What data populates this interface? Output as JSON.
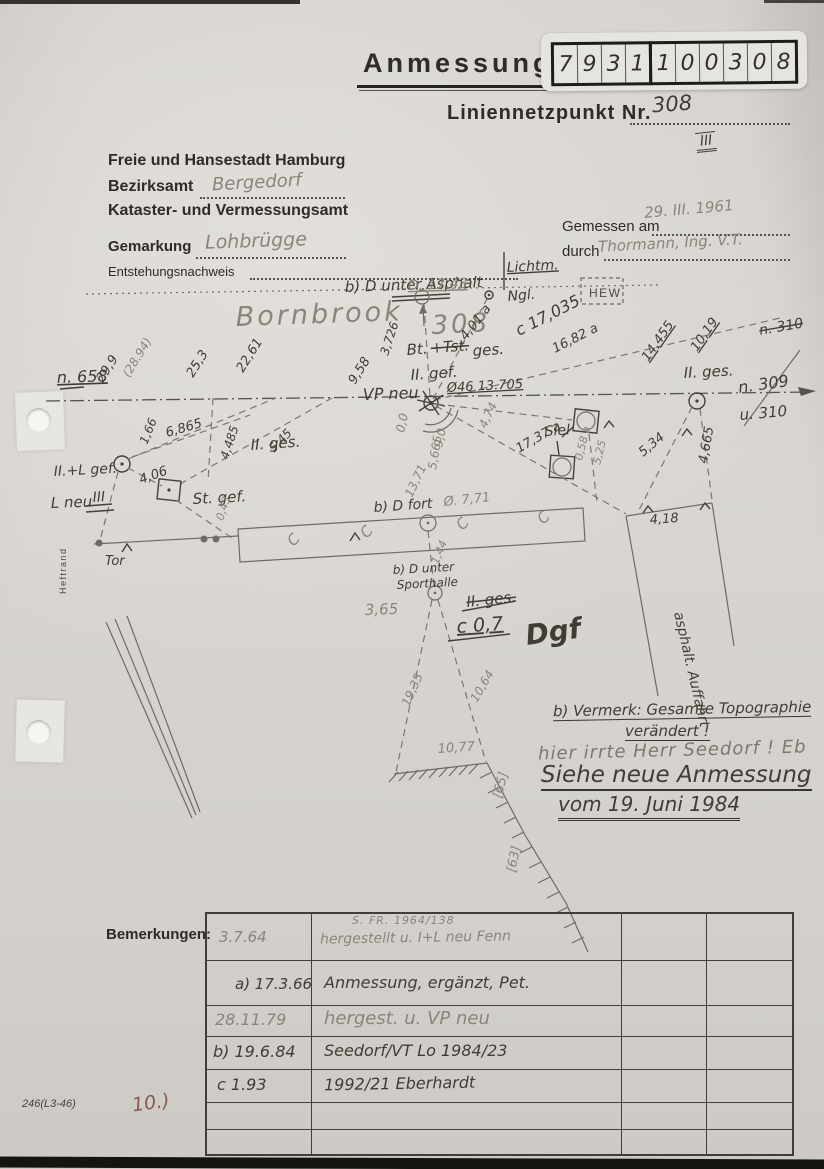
{
  "page": {
    "title": "Anmessung",
    "form_number": "246(L3-46)",
    "page_note": "10.)"
  },
  "number_box": {
    "digits": [
      "7",
      "9",
      "3",
      "1",
      "1",
      "0",
      "0",
      "3",
      "0",
      "8"
    ]
  },
  "point": {
    "label": "Liniennetzpunkt Nr.",
    "value": "308",
    "revision_mark": "III"
  },
  "header": {
    "authority_line1": "Freie und Hansestadt Hamburg",
    "bezirksamt_label": "Bezirksamt",
    "bezirksamt_value": "Bergedorf",
    "authority_line2": "Kataster- und Vermessungsamt",
    "gemarkung_label": "Gemarkung",
    "gemarkung_value": "Lohbrügge",
    "entstehung_label": "Entstehungsnachweis",
    "gemessen_label": "Gemessen am",
    "gemessen_value": "29. III. 1961",
    "durch_label": "durch",
    "durch_value": "Thormann, Ing. V.T."
  },
  "notes": {
    "vermerk_line1": "b) Vermerk: Gesamte Topographie",
    "vermerk_line2": "verändert !",
    "pencil_note": "hier irrte Herr Seedorf ! Eb",
    "see_new_line1": "Siehe neue Anmessung",
    "see_new_line2": "vom 19. Juni 1984"
  },
  "remarks_table": {
    "label": "Bemerkungen:",
    "rows": [
      {
        "date": "3.7.64",
        "note_top": "S. FR. 1964/138",
        "note": "hergestellt u. I+L neu Fenn"
      },
      {
        "date": "a) 17.3.66",
        "note_top": "",
        "note": "Anmessung, ergänzt, Pet."
      },
      {
        "date": "28.11.79",
        "note_top": "",
        "note": "hergest. u. VP neu"
      },
      {
        "date": "b) 19.6.84",
        "note_top": "",
        "note": "Seedorf/VT  Lo 1984/23"
      },
      {
        "date": "c  1.93",
        "note_top": "",
        "note": "1992/21  Eberhardt"
      },
      {
        "date": "",
        "note_top": "",
        "note": ""
      },
      {
        "date": "",
        "note_top": "",
        "note": ""
      }
    ]
  },
  "sketch": {
    "labels": [
      {
        "t": "Lichtm.",
        "x": 507,
        "y": 272,
        "r": -3,
        "c": "ink u",
        "s": 14
      },
      {
        "t": "b) D unter Asphalt",
        "x": 345,
        "y": 292,
        "r": -2,
        "c": "ink",
        "s": 15
      },
      {
        "t": "D. 17.43",
        "x": 408,
        "y": 290,
        "r": -2,
        "c": "pencil u",
        "s": 14
      },
      {
        "t": "Bornbrook",
        "x": 236,
        "y": 326,
        "r": -2,
        "c": "pencil big",
        "s": 27
      },
      {
        "t": "308",
        "x": 432,
        "y": 334,
        "r": -3,
        "c": "pencil big",
        "s": 26
      },
      {
        "t": "Ngl.",
        "x": 508,
        "y": 301,
        "r": -5,
        "c": "ink",
        "s": 14
      },
      {
        "t": "4,01 a",
        "x": 466,
        "y": 341,
        "r": -52,
        "c": "ink",
        "s": 13
      },
      {
        "t": "c 17,035",
        "x": 519,
        "y": 336,
        "r": -27,
        "c": "ink",
        "s": 16
      },
      {
        "t": "16,82 a",
        "x": 555,
        "y": 353,
        "r": -27,
        "c": "ink",
        "s": 13
      },
      {
        "t": "HEW",
        "x": 589,
        "y": 297,
        "r": 0,
        "c": "print",
        "s": 12
      },
      {
        "t": "n. 310",
        "x": 760,
        "y": 335,
        "r": -10,
        "c": "ink strike",
        "s": 14
      },
      {
        "t": "14,455",
        "x": 648,
        "y": 362,
        "r": -55,
        "c": "ink u",
        "s": 13
      },
      {
        "t": "10,19",
        "x": 697,
        "y": 352,
        "r": -55,
        "c": "ink u",
        "s": 13
      },
      {
        "t": "II. ges.",
        "x": 684,
        "y": 378,
        "r": -3,
        "c": "ink",
        "s": 15
      },
      {
        "t": "n. 309",
        "x": 739,
        "y": 393,
        "r": -8,
        "c": "ink",
        "s": 16
      },
      {
        "t": "u. 310",
        "x": 740,
        "y": 420,
        "r": -5,
        "c": "ink",
        "s": 15
      },
      {
        "t": "n. 658",
        "x": 57,
        "y": 383,
        "r": -2,
        "c": "ink u",
        "s": 16
      },
      {
        "t": "29,9",
        "x": 103,
        "y": 383,
        "r": -58,
        "c": "ink",
        "s": 13
      },
      {
        "t": "(28.94)",
        "x": 129,
        "y": 378,
        "r": -58,
        "c": "pencil",
        "s": 12
      },
      {
        "t": "25,3",
        "x": 193,
        "y": 378,
        "r": -58,
        "c": "ink",
        "s": 13
      },
      {
        "t": "22,61",
        "x": 243,
        "y": 373,
        "r": -58,
        "c": "ink",
        "s": 13
      },
      {
        "t": "9,58",
        "x": 355,
        "y": 385,
        "r": -58,
        "c": "ink",
        "s": 13
      },
      {
        "t": "3,726",
        "x": 388,
        "y": 356,
        "r": -72,
        "c": "ink",
        "s": 12
      },
      {
        "t": "Bt.",
        "x": 407,
        "y": 355,
        "r": -4,
        "c": "ink",
        "s": 15
      },
      {
        "t": "+Tst.",
        "x": 431,
        "y": 353,
        "r": -4,
        "c": "ink strike",
        "s": 15
      },
      {
        "t": "ges.",
        "x": 473,
        "y": 356,
        "r": -4,
        "c": "ink",
        "s": 15
      },
      {
        "t": "II. gef.",
        "x": 411,
        "y": 380,
        "r": -4,
        "c": "ink",
        "s": 15
      },
      {
        "t": "VP neu",
        "x": 363,
        "y": 400,
        "r": -2,
        "c": "ink",
        "s": 16
      },
      {
        "t": "Ø46 13.705",
        "x": 447,
        "y": 392,
        "r": -3,
        "c": "ink u",
        "s": 13
      },
      {
        "t": "0,0",
        "x": 404,
        "y": 433,
        "r": -78,
        "c": "pencil",
        "s": 12
      },
      {
        "t": "9,0",
        "x": 442,
        "y": 448,
        "r": -78,
        "c": "pencil",
        "s": 12
      },
      {
        "t": "5,665",
        "x": 436,
        "y": 470,
        "r": -80,
        "c": "pencil",
        "s": 12
      },
      {
        "t": "4,74",
        "x": 486,
        "y": 429,
        "r": -65,
        "c": "pencil",
        "s": 12
      },
      {
        "t": "13,71",
        "x": 412,
        "y": 498,
        "r": -65,
        "c": "pencil",
        "s": 12
      },
      {
        "t": "Ø. 7,71",
        "x": 444,
        "y": 506,
        "r": -6,
        "c": "pencil",
        "s": 13
      },
      {
        "t": "b) D fort",
        "x": 374,
        "y": 512,
        "r": -4,
        "c": "ink",
        "s": 14
      },
      {
        "t": "17,37 a",
        "x": 519,
        "y": 453,
        "r": -30,
        "c": "ink",
        "s": 13
      },
      {
        "t": "1,66",
        "x": 147,
        "y": 445,
        "r": -68,
        "c": "ink",
        "s": 12
      },
      {
        "t": "6,865",
        "x": 167,
        "y": 437,
        "r": -16,
        "c": "ink",
        "s": 13
      },
      {
        "t": "4,485",
        "x": 228,
        "y": 460,
        "r": -72,
        "c": "ink",
        "s": 12
      },
      {
        "t": "5,45",
        "x": 274,
        "y": 453,
        "r": -46,
        "c": "ink",
        "s": 12
      },
      {
        "t": "II.+L gef.",
        "x": 54,
        "y": 476,
        "r": -3,
        "c": "ink",
        "s": 14
      },
      {
        "t": "4,06",
        "x": 141,
        "y": 484,
        "r": -20,
        "c": "ink",
        "s": 13
      },
      {
        "t": "L neu",
        "x": 51,
        "y": 508,
        "r": -2,
        "c": "ink",
        "s": 15
      },
      {
        "t": "III",
        "x": 93,
        "y": 502,
        "r": -4,
        "c": "ink",
        "s": 14
      },
      {
        "t": "St. gef.",
        "x": 193,
        "y": 504,
        "r": -3,
        "c": "ink",
        "s": 15
      },
      {
        "t": "II. ges.",
        "x": 251,
        "y": 450,
        "r": -4,
        "c": "ink",
        "s": 15
      },
      {
        "t": "0,43",
        "x": 223,
        "y": 521,
        "r": -72,
        "c": "pencil",
        "s": 11
      },
      {
        "t": "Tor",
        "x": 105,
        "y": 565,
        "r": 0,
        "c": "ink",
        "s": 13
      },
      {
        "t": "Heftrand",
        "x": 66,
        "y": 594,
        "r": -90,
        "c": "print-sm",
        "s": 9
      },
      {
        "t": "Siel",
        "x": 545,
        "y": 436,
        "r": -4,
        "c": "ink",
        "s": 14
      },
      {
        "t": "0,58 a",
        "x": 582,
        "y": 461,
        "r": -76,
        "c": "pencil",
        "s": 11
      },
      {
        "t": "5,25",
        "x": 600,
        "y": 465,
        "r": -76,
        "c": "pencil",
        "s": 11
      },
      {
        "t": "5,34",
        "x": 643,
        "y": 457,
        "r": -40,
        "c": "ink",
        "s": 13
      },
      {
        "t": "4,665",
        "x": 707,
        "y": 464,
        "r": -80,
        "c": "ink",
        "s": 13
      },
      {
        "t": "4,18",
        "x": 650,
        "y": 524,
        "r": -4,
        "c": "ink",
        "s": 13
      },
      {
        "t": "asphalt. Auffahrt",
        "x": 674,
        "y": 613,
        "r": 77,
        "c": "ink",
        "s": 14
      },
      {
        "t": "b) D unter",
        "x": 393,
        "y": 574,
        "r": -3,
        "c": "ink",
        "s": 12
      },
      {
        "t": "Sporthalle",
        "x": 397,
        "y": 589,
        "r": -3,
        "c": "ink",
        "s": 12
      },
      {
        "t": "3,65",
        "x": 365,
        "y": 615,
        "r": -2,
        "c": "pencil",
        "s": 15
      },
      {
        "t": "II. ges.",
        "x": 467,
        "y": 607,
        "r": -6,
        "c": "ink strike",
        "s": 15
      },
      {
        "t": "c 0,7",
        "x": 457,
        "y": 633,
        "r": -4,
        "c": "ink u",
        "s": 19
      },
      {
        "t": "Dgf",
        "x": 527,
        "y": 645,
        "r": -8,
        "c": "ink sig",
        "s": 28
      },
      {
        "t": "1,44",
        "x": 438,
        "y": 565,
        "r": -68,
        "c": "pencil",
        "s": 11
      },
      {
        "t": "19,35",
        "x": 409,
        "y": 707,
        "r": -66,
        "c": "pencil",
        "s": 12
      },
      {
        "t": "10,64",
        "x": 477,
        "y": 703,
        "r": -60,
        "c": "pencil",
        "s": 12
      },
      {
        "t": "10,77",
        "x": 438,
        "y": 753,
        "r": -4,
        "c": "pencil",
        "s": 13
      },
      {
        "t": "[65]",
        "x": 501,
        "y": 799,
        "r": -75,
        "c": "pencil",
        "s": 13
      },
      {
        "t": "[63]",
        "x": 515,
        "y": 873,
        "r": -78,
        "c": "pencil",
        "s": 13
      },
      {
        "t": "C",
        "x": 294,
        "y": 547,
        "r": -50,
        "c": "pencil",
        "s": 15
      },
      {
        "t": "C",
        "x": 367,
        "y": 539,
        "r": -50,
        "c": "pencil",
        "s": 15
      },
      {
        "t": "C",
        "x": 463,
        "y": 531,
        "r": -50,
        "c": "pencil",
        "s": 15
      },
      {
        "t": "C",
        "x": 544,
        "y": 525,
        "r": -50,
        "c": "pencil",
        "s": 15
      }
    ]
  },
  "colors": {
    "paper": "#d9d6d1",
    "ink": "#413c35",
    "pencil": "#8a847c",
    "red_note": "#8a5a50"
  }
}
